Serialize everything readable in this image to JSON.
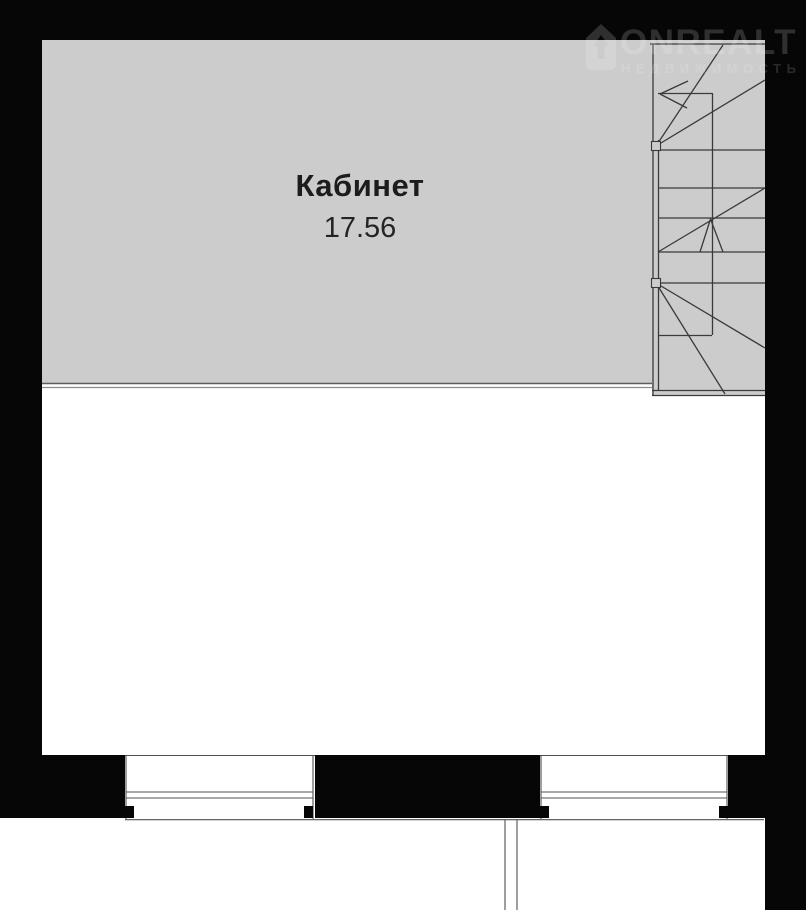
{
  "plan": {
    "room": {
      "name": "Кабинет",
      "area": "17.56"
    },
    "watermark": {
      "brand": "ONREALT",
      "tagline": "НЕДВИЖИМОСТЬ"
    },
    "colors": {
      "wall": "#060606",
      "room_fill": "#cccccc",
      "line": "#3a3a3a",
      "thin_line": "#505050",
      "border_line": "#6f6f6f",
      "text": "#1c1c1c",
      "watermark": "rgba(255,255,255,0.17)",
      "background": "#ffffff"
    }
  }
}
